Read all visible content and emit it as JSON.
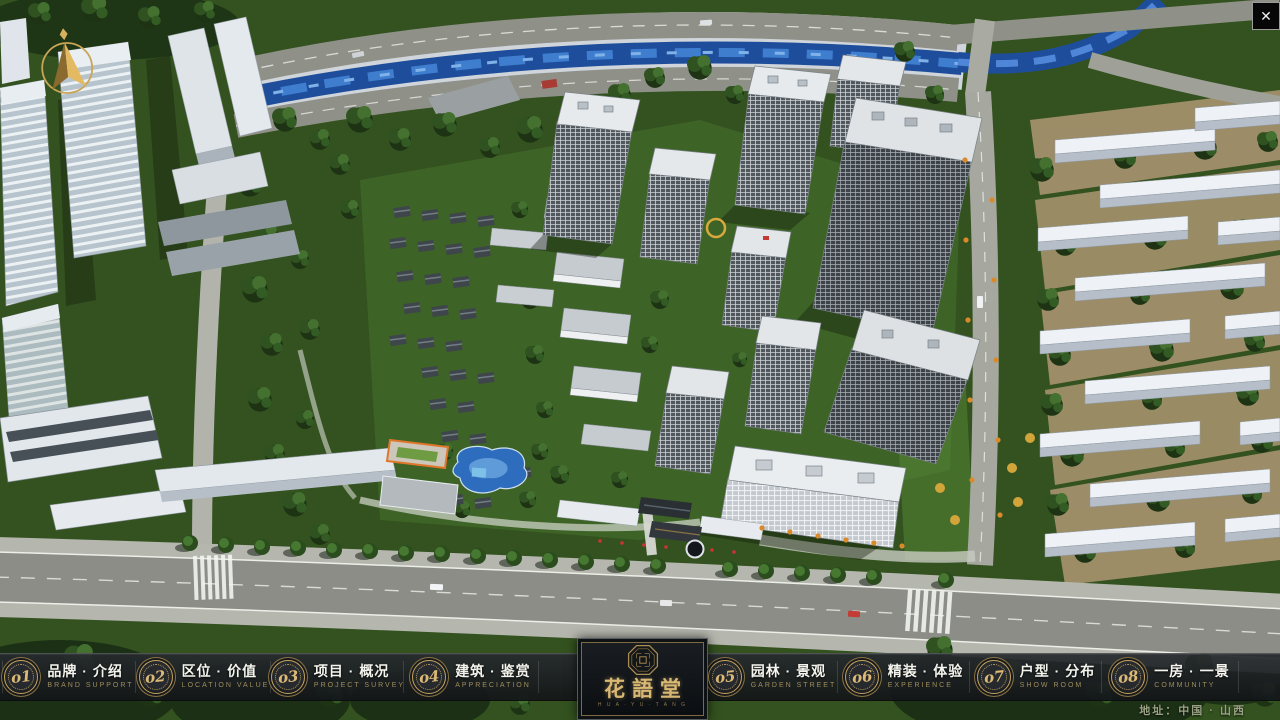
{
  "theme": {
    "gold": "#c9a55c",
    "bar_bg": "#1b1e22",
    "label_color": "#f4f4ee",
    "sub_gold": "#9f8d5c"
  },
  "header": {
    "close_icon": "✕"
  },
  "nav": {
    "items": [
      {
        "num": "o1",
        "label": "品牌 · 介绍",
        "sub": "BRAND SUPPORT"
      },
      {
        "num": "o2",
        "label": "区位 · 价值",
        "sub": "LOCATION VALUE"
      },
      {
        "num": "o3",
        "label": "项目 · 概况",
        "sub": "PROJECT SURVEY"
      },
      {
        "num": "o4",
        "label": "建筑 · 鉴赏",
        "sub": "APPRECIATION"
      },
      {
        "num": "o5",
        "label": "园林 · 景观",
        "sub": "GARDEN STREET"
      },
      {
        "num": "o6",
        "label": "精装 · 体验",
        "sub": "EXPERIENCE"
      },
      {
        "num": "o7",
        "label": "户型 · 分布",
        "sub": "SHOW ROOM"
      },
      {
        "num": "o8",
        "label": "一房 · 一景",
        "sub": "COMMUNITY"
      }
    ]
  },
  "logo": {
    "title": "花語堂",
    "subtext": "H U A · Y U · T A N G"
  },
  "footer": {
    "address": "地址：中国 · 山西"
  }
}
